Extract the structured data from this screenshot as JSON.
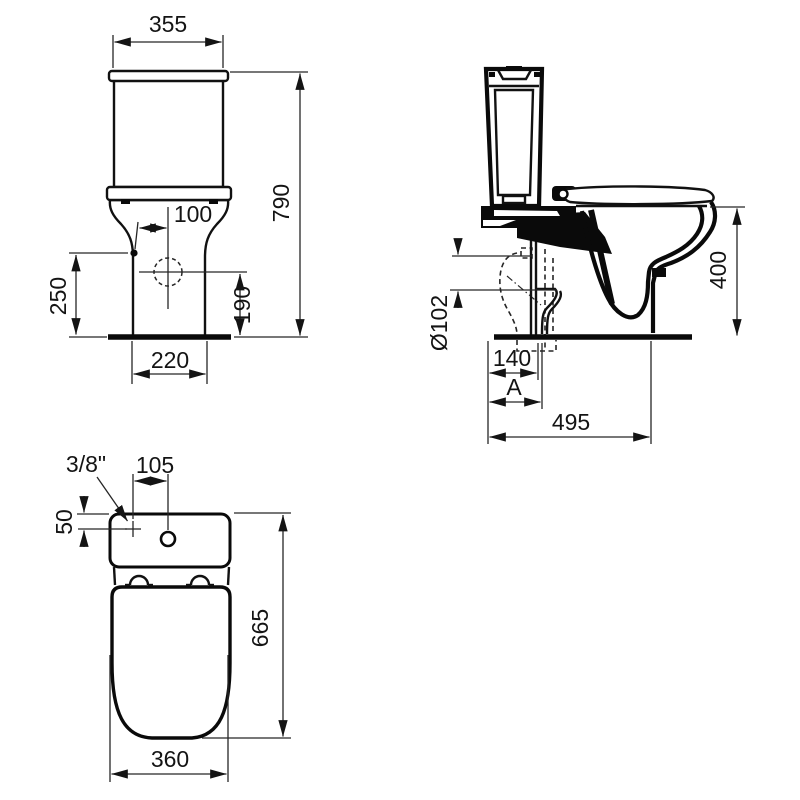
{
  "page": {
    "background": "#ffffff",
    "line_color": "#0a0a0a"
  },
  "views": {
    "front": {
      "label": "front-elevation",
      "dims": {
        "tank_width": "355",
        "overall_height": "790",
        "inlet_offset": "100",
        "inlet_height_side": "250",
        "inlet_height_front": "190",
        "base_width": "220"
      }
    },
    "side": {
      "label": "side-elevation",
      "dims": {
        "seat_height": "400",
        "outlet_diameter": "Ø102",
        "outlet_setout": "140",
        "rough_in": "A",
        "depth": "495"
      }
    },
    "plan": {
      "label": "plan-view",
      "dims": {
        "inlet_thread": "3/8\"",
        "button_offset": "105",
        "inlet_setback": "50",
        "overall_depth": "665",
        "seat_width": "360"
      }
    }
  }
}
